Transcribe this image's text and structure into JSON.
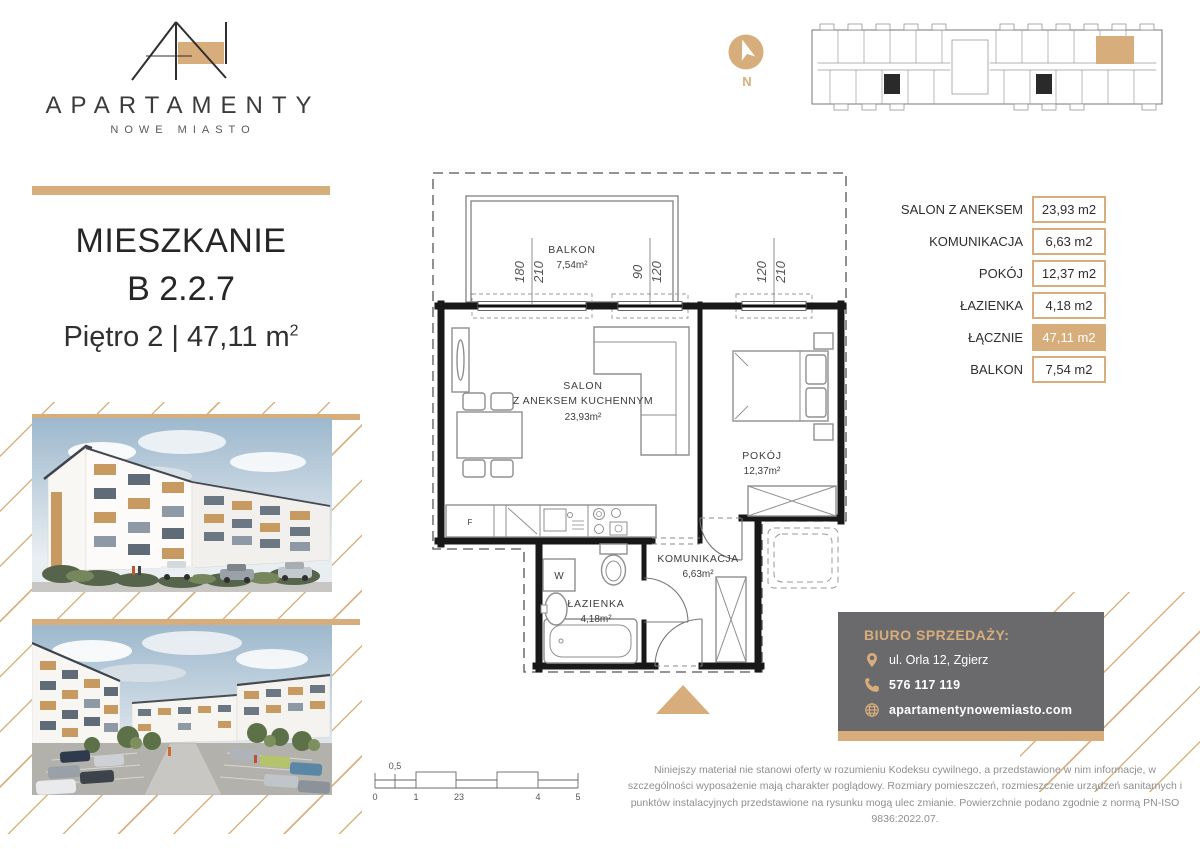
{
  "brand": {
    "logo_title": "APARTAMENTY",
    "logo_subtitle": "NOWE MIASTO"
  },
  "listing": {
    "heading": "MIESZKANIE",
    "unit": "B 2.2.7",
    "floor_line": "Piętro 2 | 47,11 m",
    "floor_sup": "2"
  },
  "compass": {
    "north_label": "N"
  },
  "area_table": {
    "rows": [
      {
        "label": "SALON Z ANEKSEM",
        "value": "23,93 m2",
        "highlight": false
      },
      {
        "label": "KOMUNIKACJA",
        "value": "6,63 m2",
        "highlight": false
      },
      {
        "label": "POKÓJ",
        "value": "12,37 m2",
        "highlight": false
      },
      {
        "label": "ŁAZIENKA",
        "value": "4,18 m2",
        "highlight": false
      },
      {
        "label": "ŁĄCZNIE",
        "value": "47,11 m2",
        "highlight": true
      },
      {
        "label": "BALKON",
        "value": "7,54 m2",
        "highlight": false
      }
    ]
  },
  "floor_plan": {
    "balkon_name": "BALKON",
    "balkon_area": "7,54m²",
    "salon_name": "SALON",
    "salon_name2": "Z ANEKSEM KUCHENNYM",
    "salon_area": "23,93m²",
    "pokoj_name": "POKÓJ",
    "pokoj_area": "12,37m²",
    "komunikacja_name": "KOMUNIKACJA",
    "komunikacja_area": "6,63m²",
    "lazienka_name": "ŁAZIENKA",
    "lazienka_area": "4,18m²",
    "washer_label": "W",
    "fridge_label": "F",
    "dims": {
      "w1a": "180",
      "w1b": "210",
      "w2a": "90",
      "w2b": "120",
      "w3a": "120",
      "w3b": "210"
    }
  },
  "contact": {
    "heading": "BIURO SPRZEDAŻY:",
    "address": "ul. Orla 12, Zgierz",
    "phone": "576 117 119",
    "website": "apartamentynowemiasto.com"
  },
  "legal": {
    "disclaimer": "Niniejszy materiał nie stanowi oferty w rozumieniu Kodeksu cywilnego, a przedstawione w nim informacje, w szczególności wyposażenie mają charakter poglądowy. Rozmiary pomieszczeń, rozmieszczenie urządzeń sanitarnych i punktów instalacyjnych przedstawione na rysunku mogą ulec zmianie. Powierzchnie podano zgodnie z normą PN-ISO 9836:2022.07."
  },
  "scale_bar": {
    "labels": [
      "0",
      "0,5",
      "1",
      "23",
      "4",
      "5"
    ]
  },
  "colors": {
    "accent": "#d7ae7b",
    "contact_box": "#6a6a6c"
  }
}
